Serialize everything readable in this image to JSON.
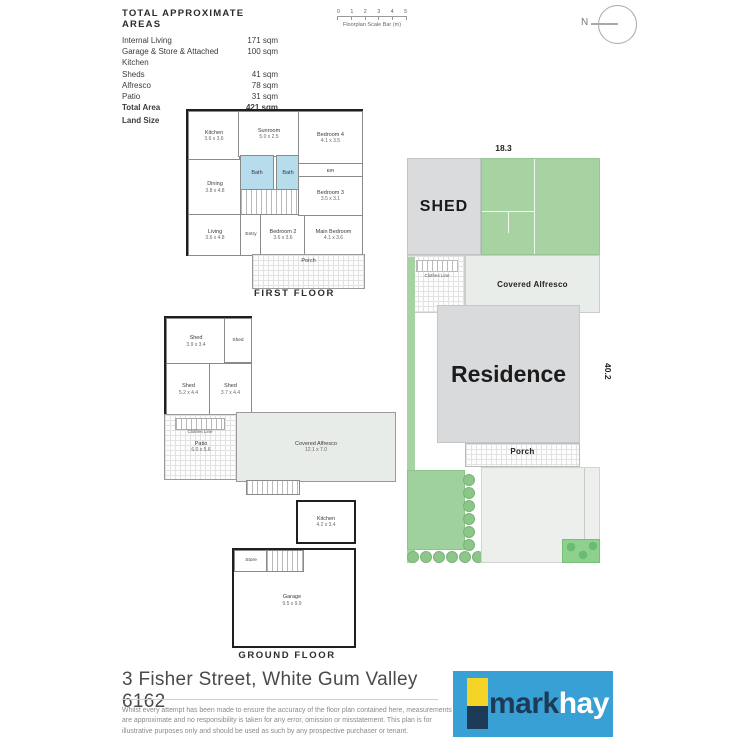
{
  "header": {
    "areas_table": {
      "title": "TOTAL APPROXIMATE AREAS",
      "rows": [
        {
          "label": "Internal Living",
          "value": "171 sqm"
        },
        {
          "label": "Garage & Store & Attached Kitchen",
          "value": "100 sqm"
        },
        {
          "label": "Sheds",
          "value": "41 sqm"
        },
        {
          "label": "Alfresco",
          "value": "78 sqm"
        },
        {
          "label": "Patio",
          "value": "31 sqm"
        },
        {
          "label": "Total Area",
          "value": "421 sqm"
        },
        {
          "label": "Land Size",
          "value": "736 sqm"
        }
      ]
    },
    "scale_bar": {
      "ticks": [
        "0",
        "1",
        "2",
        "3",
        "4",
        "5"
      ],
      "label": "Floorplan Scale Bar (m)"
    },
    "compass": {
      "north_label": "N"
    }
  },
  "first_floor": {
    "title": "FIRST FLOOR",
    "rooms": {
      "kitchen": {
        "name": "Kitchen",
        "dims": "3.6 x 3.6"
      },
      "sunroom": {
        "name": "Sunroom",
        "dims": "5.0 x 2.5"
      },
      "bedroom4": {
        "name": "Bedroom 4",
        "dims": "4.1 x 3.5"
      },
      "bath1": {
        "name": "Bath"
      },
      "bath2": {
        "name": "Bath"
      },
      "bir": {
        "name": "BIR"
      },
      "bedroom3": {
        "name": "Bedroom 3",
        "dims": "3.5 x 3.1"
      },
      "dining": {
        "name": "Dining",
        "dims": "3.8 x 4.8"
      },
      "living": {
        "name": "Living",
        "dims": "3.6 x 4.8"
      },
      "entry": {
        "name": "Entry"
      },
      "bedroom2": {
        "name": "Bedroom 2",
        "dims": "3.6 x 3.6"
      },
      "main_bedroom": {
        "name": "Main Bedroom",
        "dims": "4.1 x 3.6"
      },
      "porch": {
        "name": "Porch"
      }
    }
  },
  "ground_floor": {
    "title": "GROUND FLOOR",
    "rooms": {
      "shed1": {
        "name": "Shed",
        "dims": "3.9 x 3.4"
      },
      "shed2": {
        "name": "Shed"
      },
      "shed3": {
        "name": "Shed",
        "dims": "5.2 x 4.4"
      },
      "shed4": {
        "name": "Shed",
        "dims": "3.7 x 4.4"
      },
      "clothes_line": {
        "name": "Clothes Line"
      },
      "patio": {
        "name": "Patio",
        "dims": "6.0 x 5.6"
      },
      "covered_alfresco": {
        "name": "Covered Alfresco",
        "dims": "12.1 x 7.0"
      },
      "kitchen": {
        "name": "Kitchen",
        "dims": "4.2 x 3.4"
      },
      "store": {
        "name": "Store"
      },
      "garage": {
        "name": "Garage",
        "dims": "9.5 x 9.9"
      }
    }
  },
  "site_plan": {
    "width_dim": "18.3",
    "depth_dim": "40.2",
    "shed_label": "SHED",
    "clothes_line_label": "Clothes Line",
    "alfresco_label": "Covered Alfresco",
    "residence_label": "Residence",
    "porch_label": "Porch"
  },
  "footer": {
    "address": "3 Fisher Street, White Gum Valley 6162",
    "disclaimer": "Whilst every attempt has been made to ensure the accuracy of the floor plan contained here, measurements are approximate and no responsibility is taken for any error, omission or misstatement. This plan is for illustrative purposes only and should be used as such by any prospective purchaser or tenant.",
    "logo": {
      "part1": "mark",
      "part2": "hay"
    }
  },
  "colors": {
    "brand_blue": "#39a0d6",
    "brand_navy": "#1d3a56",
    "brand_yellow": "#f4d525",
    "site_green": "#a7d3a2",
    "bath_blue": "#b7dcec",
    "residence_gray": "#d8dadc"
  }
}
